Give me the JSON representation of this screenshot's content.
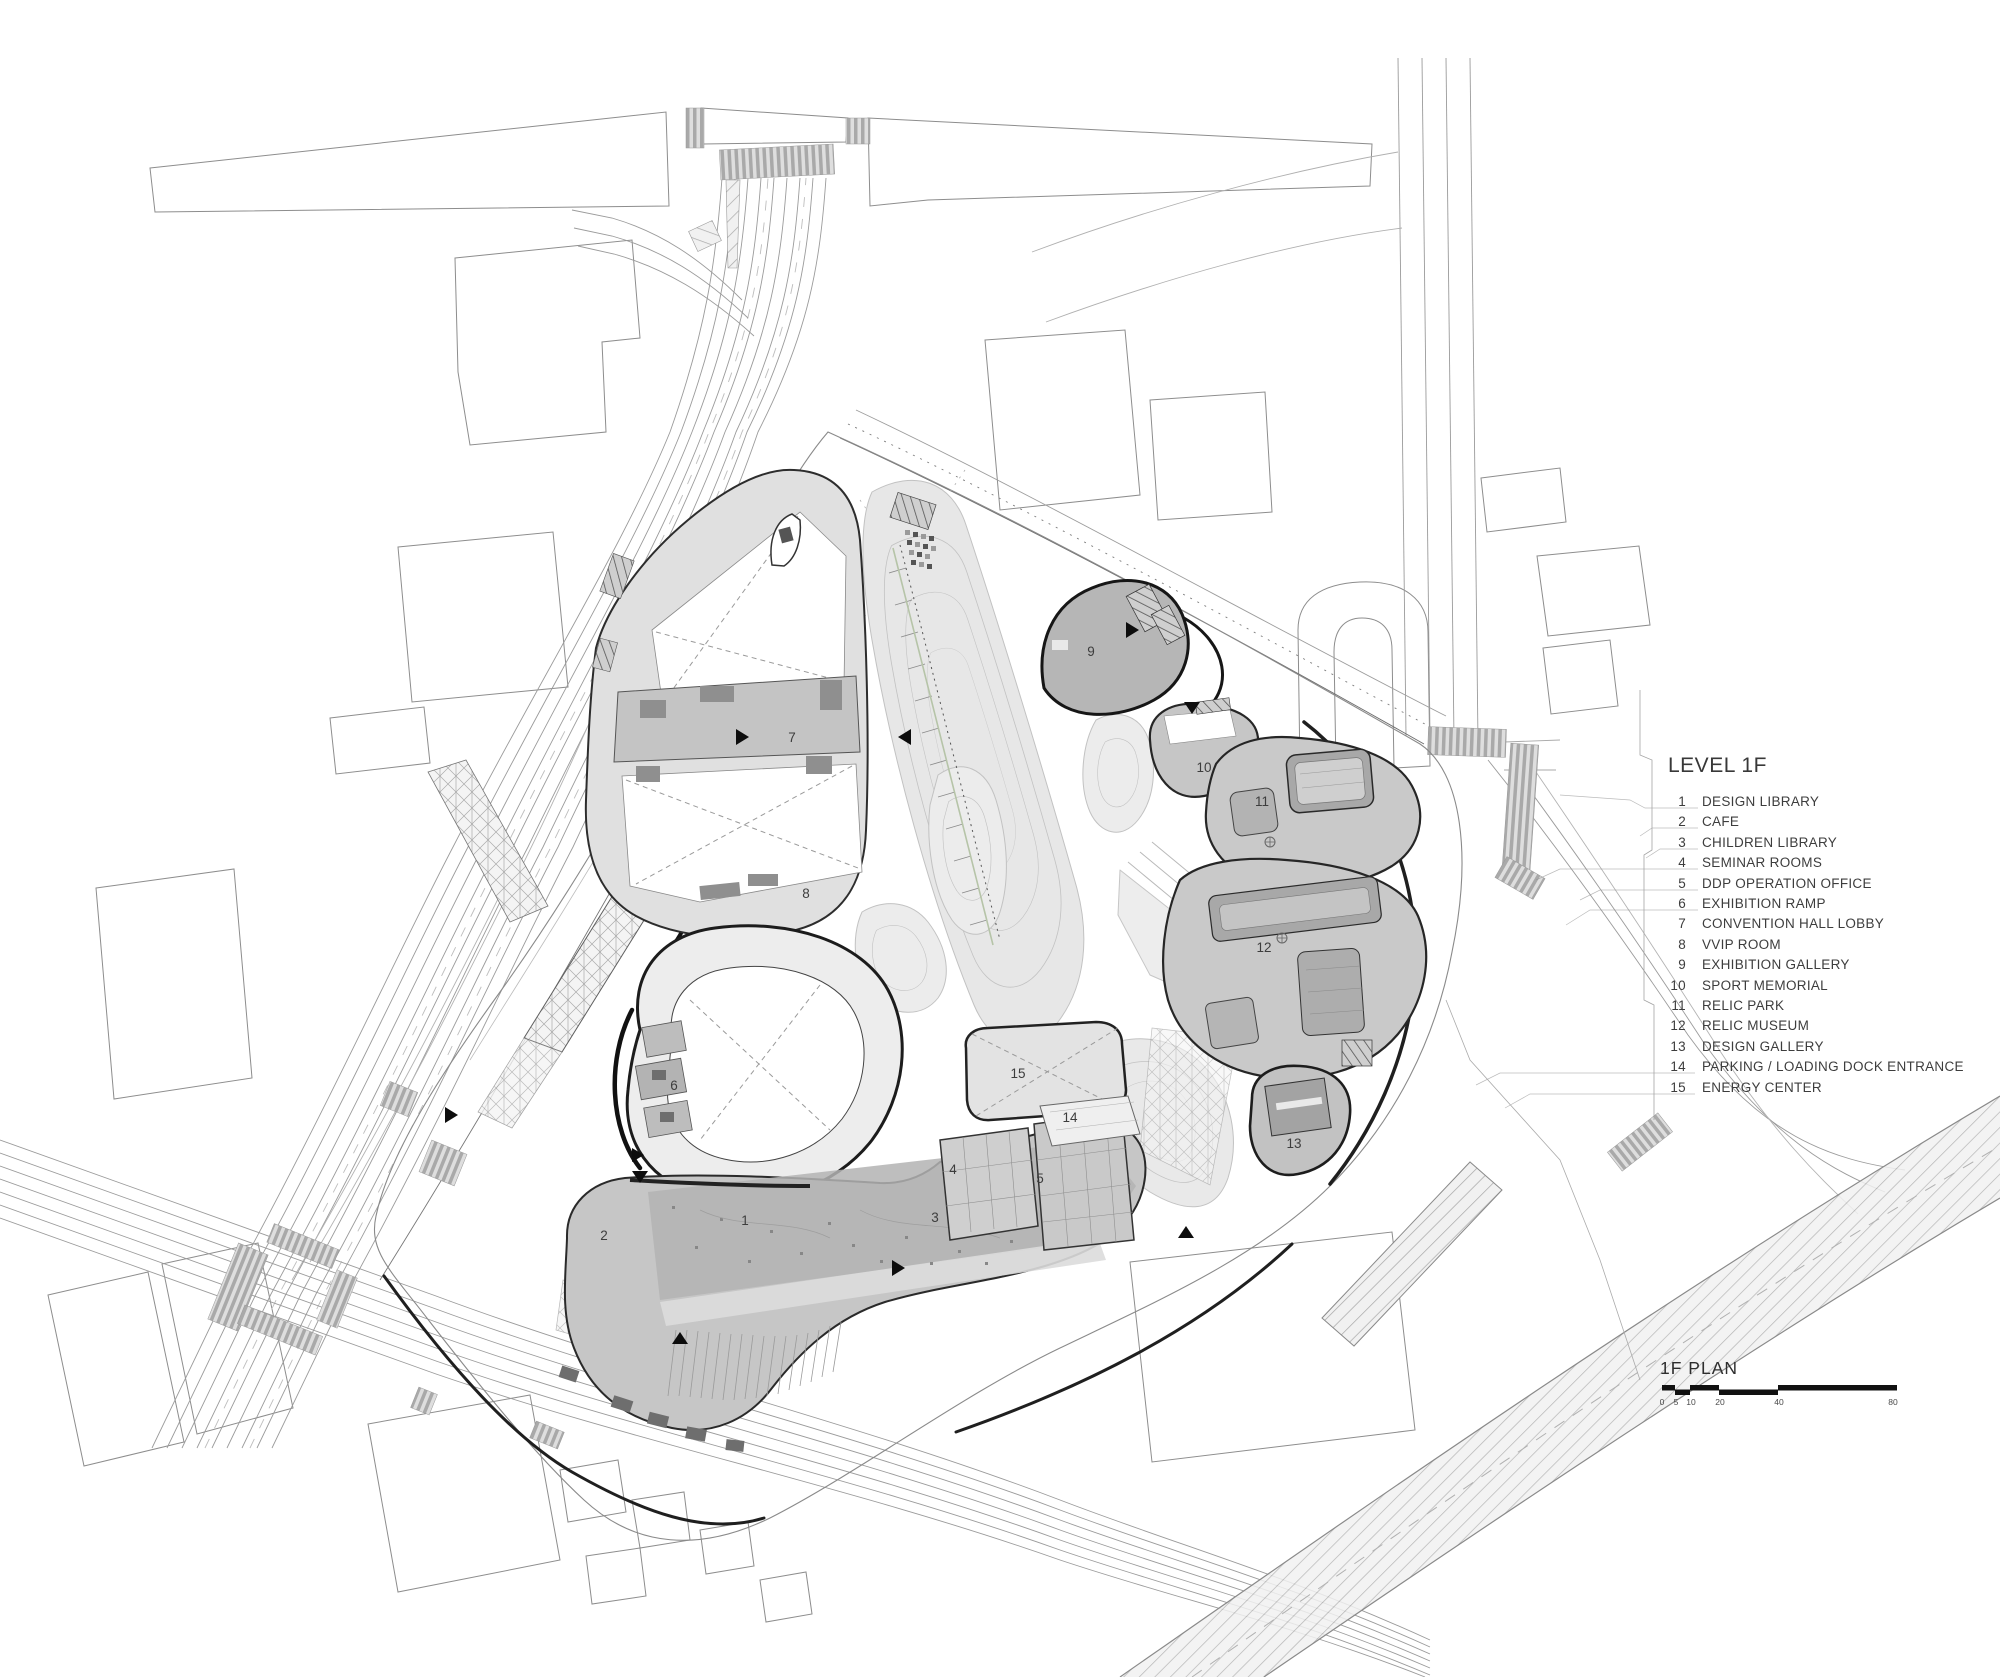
{
  "drawing": {
    "legend": {
      "heading": "LEVEL 1F",
      "items": [
        {
          "num": "1",
          "label": "DESIGN LIBRARY"
        },
        {
          "num": "2",
          "label": "CAFE"
        },
        {
          "num": "3",
          "label": "CHILDREN LIBRARY"
        },
        {
          "num": "4",
          "label": "SEMINAR ROOMS"
        },
        {
          "num": "5",
          "label": "DDP OPERATION OFFICE"
        },
        {
          "num": "6",
          "label": "EXHIBITION RAMP"
        },
        {
          "num": "7",
          "label": "CONVENTION HALL LOBBY"
        },
        {
          "num": "8",
          "label": "VVIP ROOM"
        },
        {
          "num": "9",
          "label": "EXHIBITION GALLERY"
        },
        {
          "num": "10",
          "label": "SPORT MEMORIAL"
        },
        {
          "num": "11",
          "label": "RELIC PARK"
        },
        {
          "num": "12",
          "label": "RELIC MUSEUM"
        },
        {
          "num": "13",
          "label": "DESIGN GALLERY"
        },
        {
          "num": "14",
          "label": "PARKING / LOADING DOCK ENTRANCE"
        },
        {
          "num": "15",
          "label": "ENERGY CENTER"
        }
      ]
    },
    "scale_bar": {
      "title": "1F PLAN",
      "ticks": [
        "0",
        "5",
        "10",
        "20",
        "40",
        "80"
      ]
    },
    "plan_labels": [
      {
        "n": "1"
      },
      {
        "n": "2"
      },
      {
        "n": "3"
      },
      {
        "n": "4"
      },
      {
        "n": "5"
      },
      {
        "n": "6"
      },
      {
        "n": "7"
      },
      {
        "n": "8"
      },
      {
        "n": "9"
      },
      {
        "n": "10"
      },
      {
        "n": "11"
      },
      {
        "n": "12"
      },
      {
        "n": "13"
      },
      {
        "n": "14"
      },
      {
        "n": "15"
      }
    ],
    "colors": {
      "heavy_outline": "#1a1a1a",
      "building_fill": "#c9c9c9",
      "mound_fill": "#e7e7e7",
      "accent_green": "#b6c4a8"
    }
  }
}
